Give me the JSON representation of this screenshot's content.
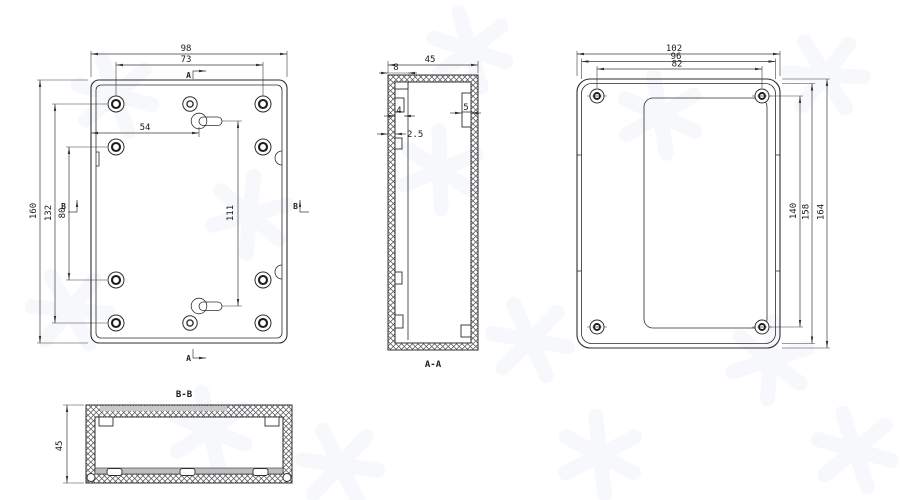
{
  "front_view": {
    "dim_width": "98",
    "dim_hole_span": "73",
    "dim_keyhole_offset": "54",
    "dim_keyhole_pitch": "111",
    "dim_height": "160",
    "dim_hole_pitch": "132",
    "dim_hole_gap": "80",
    "section_marker_a": "A",
    "section_marker_b": "B"
  },
  "section_aa": {
    "label": "A-A",
    "dim_depth": "45",
    "dim_flange": "8",
    "dim_rib_left": "4",
    "dim_rib_right": "5",
    "dim_wall": "2.5"
  },
  "back_view": {
    "dim_width": "102",
    "dim_inner_width": "96",
    "dim_hole_span": "82",
    "dim_hole_pitch": "140",
    "dim_inner_height": "158",
    "dim_height": "164"
  },
  "section_bb": {
    "label": "B-B",
    "dim_depth": "45"
  }
}
